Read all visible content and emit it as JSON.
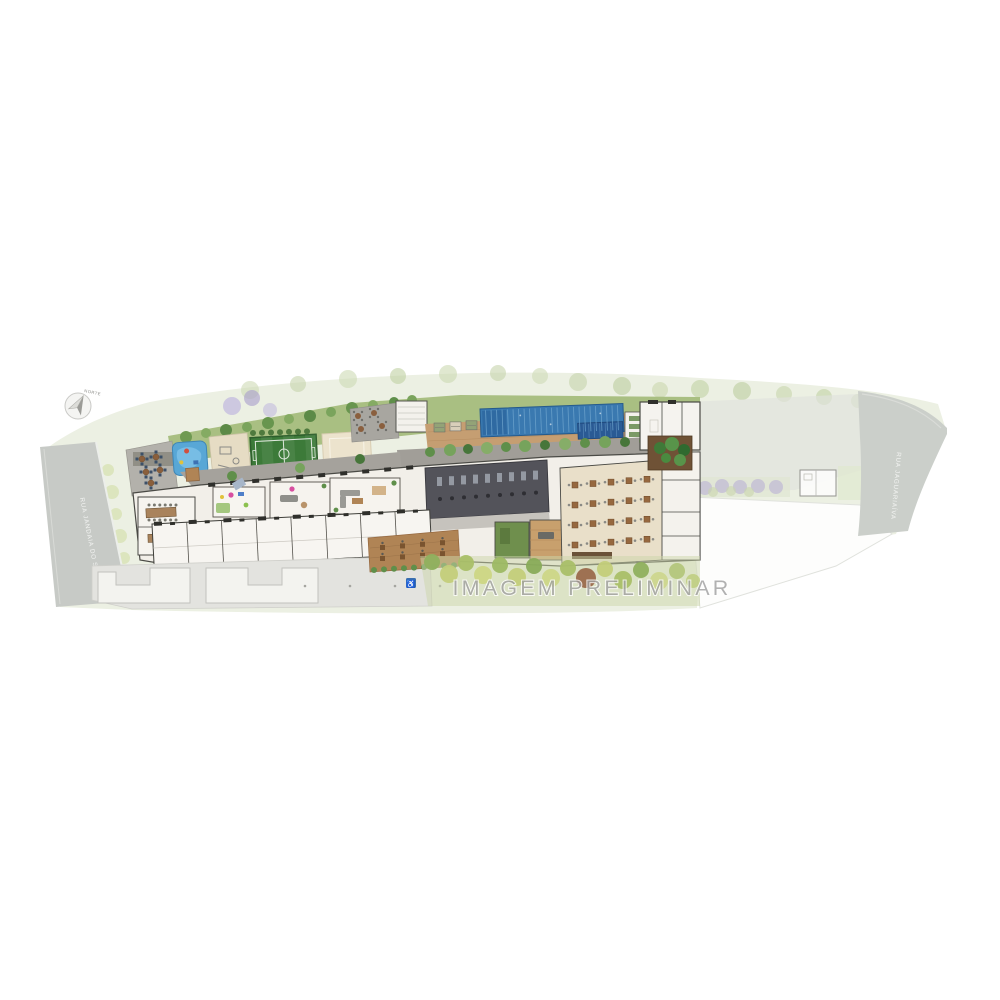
{
  "plan": {
    "watermark": "IMAGEM PRELIMINAR",
    "compass_label": "NORTE",
    "streets": {
      "left": "RUA JANDAIA DO SUL",
      "right": "RUA JAGUARIAÍVA"
    },
    "icons": {
      "accessibility_glyph": "♿",
      "compass_icon": "north-arrow"
    },
    "colors": {
      "lap_pool": "#3a79b0",
      "kids_pool": "#58a7d6",
      "sport_court": "#3c7a39",
      "sand_court": "#ece3cd",
      "wood_deck": "#c59e72",
      "lawn": "#a9bf82",
      "road": "#c7cac6",
      "building_floor": "#f2efe9",
      "gym_floor": "#53535a",
      "restaurant_floor": "#e9dfc9",
      "watermark_text": "#9f9f9f",
      "accessibility_blue": "#3a6fb0",
      "purple_trees": "#b5aad4"
    }
  }
}
